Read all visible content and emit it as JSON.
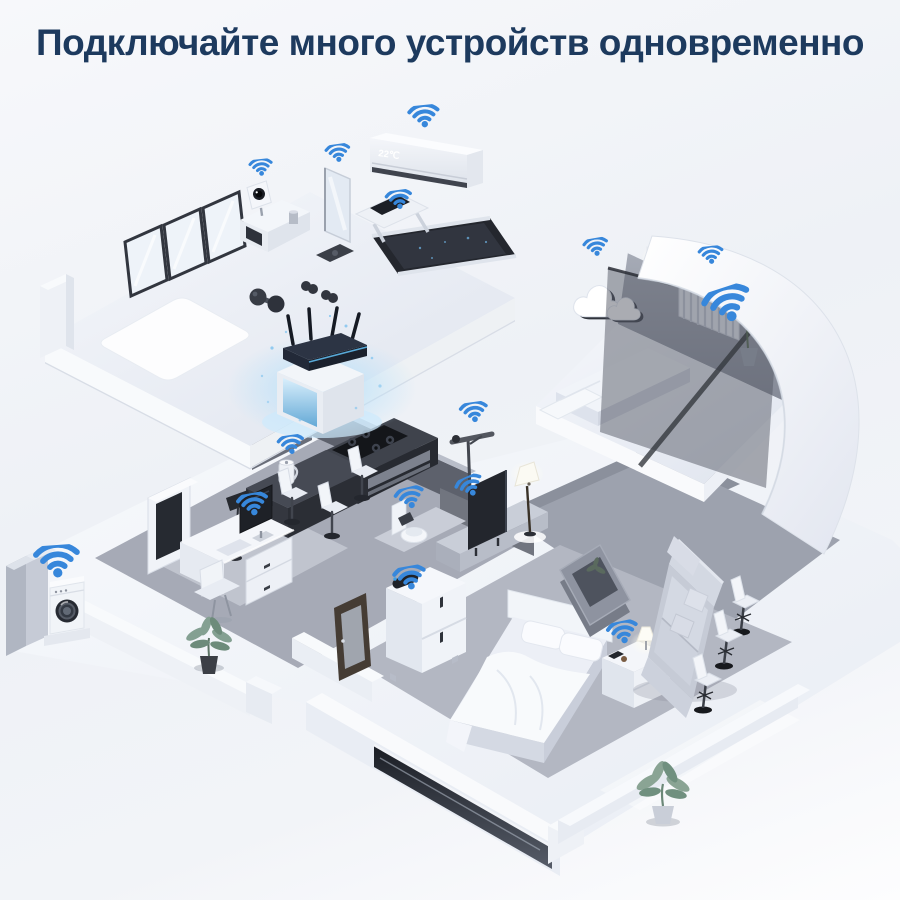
{
  "title": "Подключайте много устройств одновременно",
  "air_conditioner": {
    "display": "22℃"
  },
  "router": {
    "id": "wifi-router",
    "antenna_count": 4
  },
  "colors": {
    "title": "#1d3a5e",
    "wifi": "#3787db",
    "router_glow": "#8ecdf3",
    "background": "#eef1f6"
  },
  "wifi_icons": [
    {
      "id": "air-conditioner",
      "x": 424,
      "y": 27,
      "size": 40,
      "rotate": -6
    },
    {
      "id": "smart-mirror",
      "x": 338,
      "y": 63,
      "size": 32,
      "rotate": -8
    },
    {
      "id": "security-camera",
      "x": 261,
      "y": 78,
      "size": 30,
      "rotate": -6
    },
    {
      "id": "treadmill",
      "x": 399,
      "y": 110,
      "size": 34,
      "rotate": -8
    },
    {
      "id": "cloud-decor",
      "x": 596,
      "y": 157,
      "size": 32,
      "rotate": -10
    },
    {
      "id": "wall-lamp",
      "x": 711,
      "y": 165,
      "size": 32,
      "rotate": -6
    },
    {
      "id": "radiator",
      "x": 728,
      "y": 215,
      "size": 62,
      "rotate": -18
    },
    {
      "id": "smart-kettle",
      "x": 291,
      "y": 355,
      "size": 34,
      "rotate": -8
    },
    {
      "id": "desktop-computer",
      "x": 253,
      "y": 415,
      "size": 40,
      "rotate": -10
    },
    {
      "id": "smart-toilet",
      "x": 410,
      "y": 408,
      "size": 38,
      "rotate": -14
    },
    {
      "id": "pole-lamp",
      "x": 474,
      "y": 322,
      "size": 36,
      "rotate": -8
    },
    {
      "id": "television",
      "x": 470,
      "y": 396,
      "size": 36,
      "rotate": -24
    },
    {
      "id": "washing-machine",
      "x": 57,
      "y": 472,
      "size": 58,
      "rotate": -4
    },
    {
      "id": "bedroom-speaker",
      "x": 410,
      "y": 488,
      "size": 42,
      "rotate": -10
    },
    {
      "id": "bedside-lamp",
      "x": 623,
      "y": 543,
      "size": 40,
      "rotate": -12
    }
  ]
}
